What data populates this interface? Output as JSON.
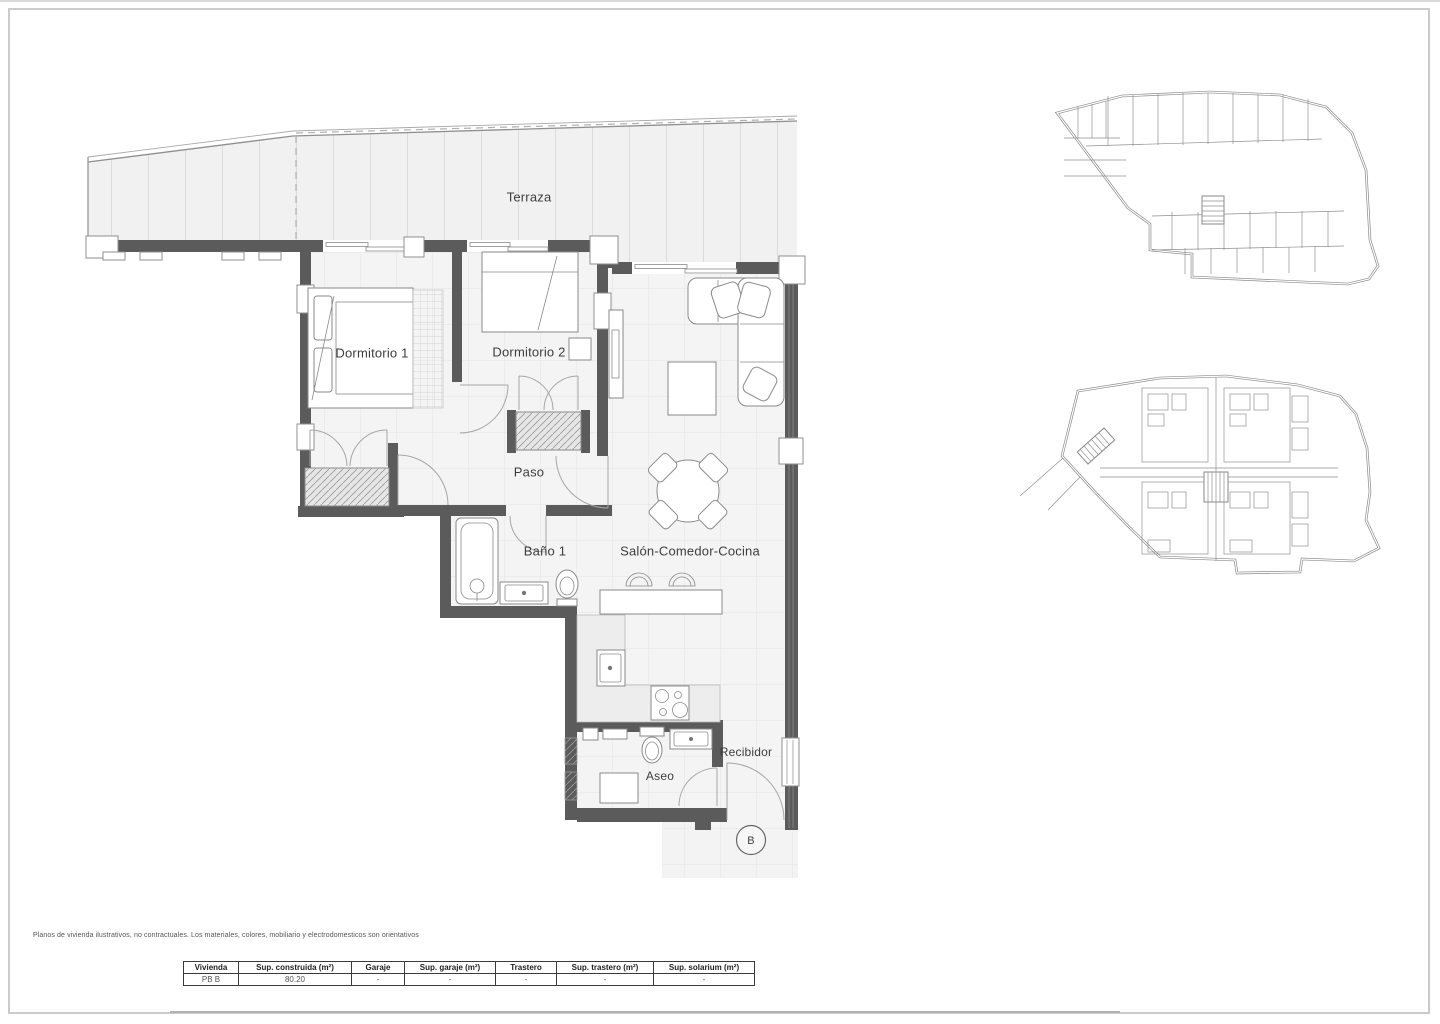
{
  "sheet": {
    "disclaimer": "Planos de vivienda ilustrativos, no contractuales. Los materiales, colores, mobiliario y electrodomesticos son orientativos",
    "colors": {
      "wall_gray": "#5b5b5b",
      "floor_gray": "#f4f4f4",
      "terrace_gray": "#f1f1f1",
      "line_gray": "#9a9a9a"
    }
  },
  "main_plan": {
    "rooms": [
      {
        "id": "terraza",
        "label": "Terraza"
      },
      {
        "id": "dormitorio-1",
        "label": "Dormitorio 1"
      },
      {
        "id": "dormitorio-2",
        "label": "Dormitorio 2"
      },
      {
        "id": "paso",
        "label": "Paso"
      },
      {
        "id": "bano-1",
        "label": "Baño 1"
      },
      {
        "id": "salon-comedor-cocina",
        "label": "Salón-Comedor-Cocina"
      },
      {
        "id": "aseo",
        "label": "Aseo"
      },
      {
        "id": "recibidor",
        "label": "Recibidor"
      }
    ],
    "unit_marker": "B"
  },
  "summary_table": {
    "headers": [
      "Vivienda",
      "Sup. construida (m²)",
      "Garaje",
      "Sup. garaje (m²)",
      "Trastero",
      "Sup. trastero (m²)",
      "Sup. solarium (m²)"
    ],
    "rows": [
      [
        "PB B",
        "80.20",
        "-",
        "-",
        "-",
        "-",
        "-"
      ]
    ]
  }
}
